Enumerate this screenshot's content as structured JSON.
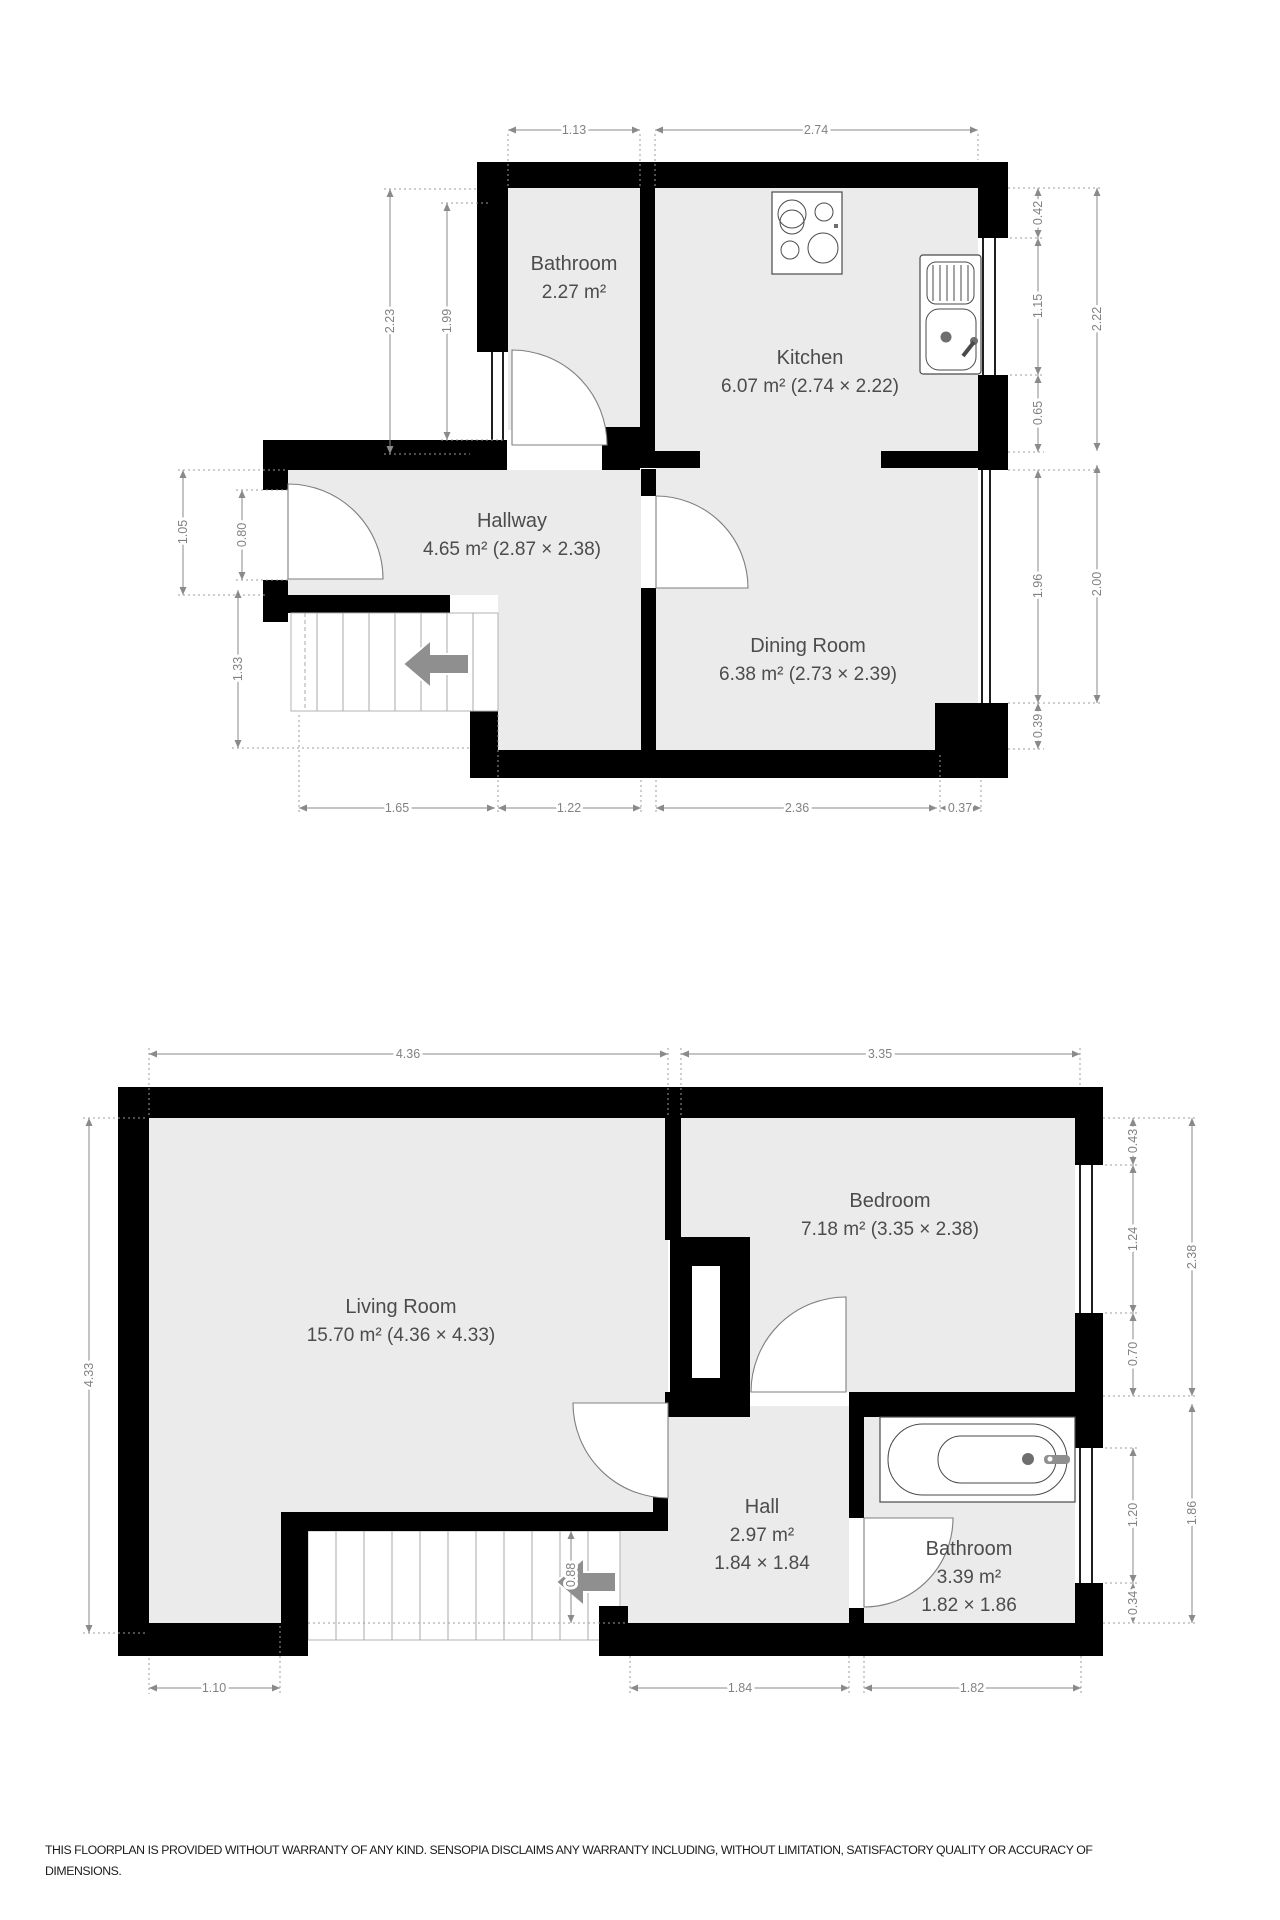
{
  "floor1": {
    "rooms": {
      "bathroom": {
        "name": "Bathroom",
        "area": "2.27 m²"
      },
      "kitchen": {
        "name": "Kitchen",
        "area": "6.07 m² (2.74 × 2.22)"
      },
      "hallway": {
        "name": "Hallway",
        "area": "4.65 m² (2.87 × 2.38)"
      },
      "dining_room": {
        "name": "Dining Room",
        "area": "6.38 m² (2.73 × 2.39)"
      }
    },
    "dims": {
      "d113": "1.13",
      "d274": "2.74",
      "d223": "2.23",
      "d199": "1.99",
      "d105": "1.05",
      "d080": "0.80",
      "d133": "1.33",
      "d042": "0.42",
      "d115": "1.15",
      "d065": "0.65",
      "d222": "2.22",
      "d196": "1.96",
      "d200": "2.00",
      "d039": "0.39",
      "d165": "1.65",
      "d122": "1.22",
      "d236": "2.36",
      "d037": "0.37"
    }
  },
  "floor2": {
    "rooms": {
      "living_room": {
        "name": "Living Room",
        "area": "15.70 m² (4.36 × 4.33)"
      },
      "bedroom": {
        "name": "Bedroom",
        "area": "7.18 m² (3.35 × 2.38)"
      },
      "hall": {
        "name": "Hall",
        "area": "2.97 m²",
        "size": "1.84 × 1.84"
      },
      "bathroom": {
        "name": "Bathroom",
        "area": "3.39 m²",
        "size": "1.82 × 1.86"
      }
    },
    "dims": {
      "d436": "4.36",
      "d335": "3.35",
      "d433": "4.33",
      "d043": "0.43",
      "d124": "1.24",
      "d070": "0.70",
      "d238": "2.38",
      "d120": "1.20",
      "d034": "0.34",
      "d186": "1.86",
      "d088": "0.88",
      "d110": "1.10",
      "d184": "1.84",
      "d182": "1.82"
    }
  },
  "footer": {
    "line1": "THIS FLOORPLAN IS PROVIDED WITHOUT WARRANTY OF ANY KIND. SENSOPIA DISCLAIMS ANY WARRANTY INCLUDING, WITHOUT LIMITATION, SATISFACTORY QUALITY OR ACCURACY OF",
    "line2": "DIMENSIONS."
  },
  "colors": {
    "wall": "#000000",
    "floor": "#ebebeb",
    "dim_line": "#8a8a8a",
    "dim_text": "#828282",
    "room_text": "#4c4c4c",
    "stair_arrow": "#8f8f8f"
  }
}
